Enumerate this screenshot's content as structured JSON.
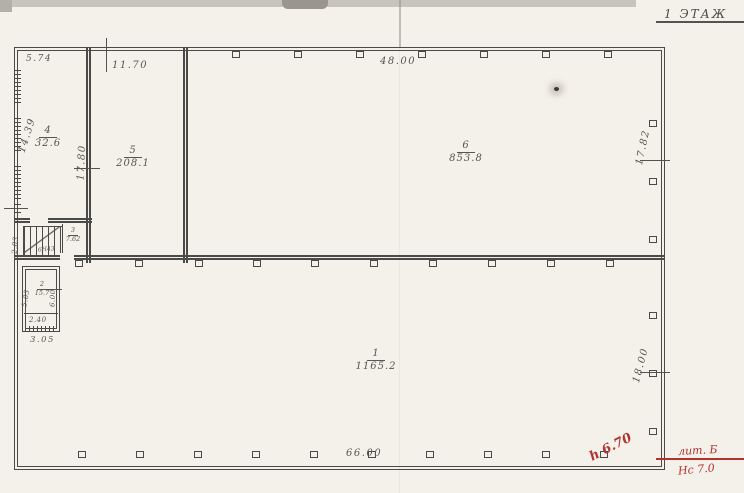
{
  "title": "1 ЭТАЖ",
  "rooms": {
    "r1": {
      "number": "1",
      "area": "1165.2"
    },
    "r2": {
      "number": "2",
      "area": "15.7"
    },
    "r3": {
      "number": "3",
      "area": "7.62"
    },
    "r4": {
      "number": "4",
      "area": "32.6"
    },
    "r5": {
      "number": "5",
      "area": "208.1"
    },
    "r6": {
      "number": "6",
      "area": "853.8"
    }
  },
  "dims": {
    "top_left": "5.74",
    "room5_width": "11.70",
    "room6_width": "48.00",
    "left_height": "14.39",
    "wall45_height": "17.80",
    "right_upper_height": "17.82",
    "right_lower_height": "18.00",
    "stair_width": "2.83",
    "room2_left_height": "5.03",
    "room2_right_height": "6.00",
    "room2_inner_width": "2.40",
    "room2_outer_width": "3.05",
    "bottom_width": "66.00"
  },
  "stair_note": "6Н43",
  "red_annotations": {
    "height_mark": "h 6.70",
    "litera": "лит. Б",
    "ns_mark": "Нс 7.0"
  },
  "colors": {
    "ink": "#4a4a48",
    "red": "#b03330",
    "paper": "#f4f1ea"
  }
}
